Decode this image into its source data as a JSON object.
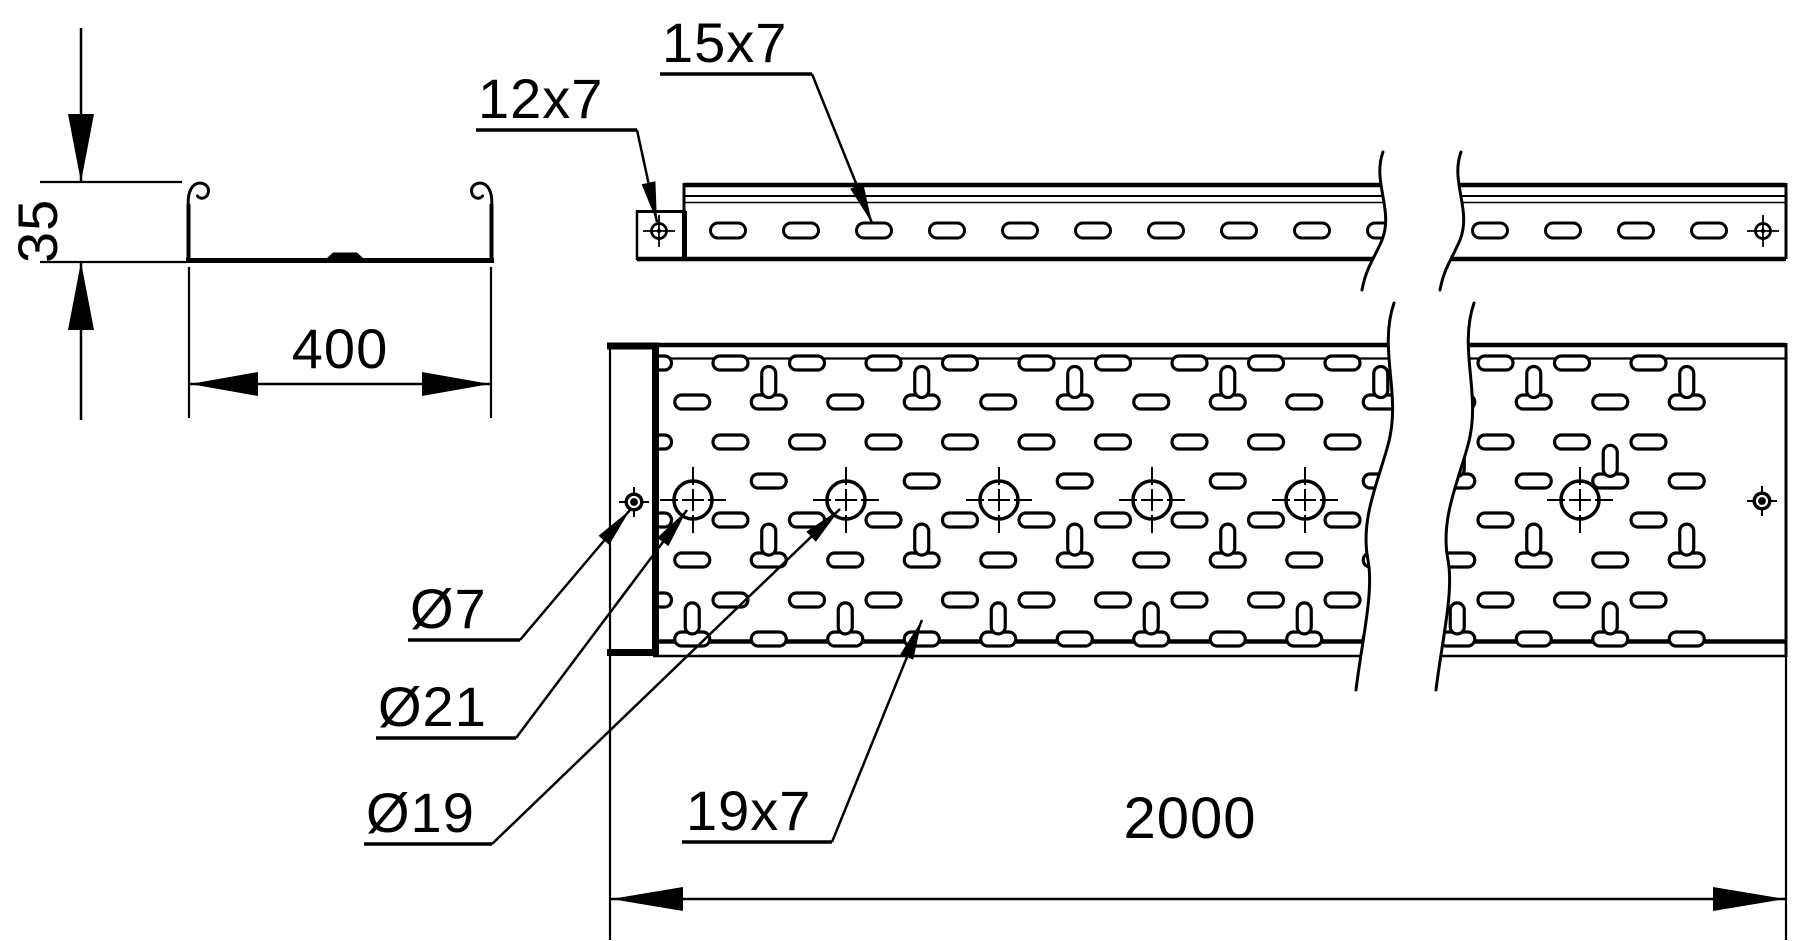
{
  "drawing": {
    "background": "#ffffff",
    "line_color": "#000000",
    "cross_section": {
      "height_value": "35",
      "width_value": "400"
    },
    "side_view": {
      "corner_hole_label": "12x7",
      "slot_label": "15x7"
    },
    "plan_view": {
      "corner_hole_label": "Ø7",
      "hole_label_large": "Ø21",
      "hole_label_medium": "Ø19",
      "slot_label": "19x7",
      "length_value": "2000"
    }
  }
}
